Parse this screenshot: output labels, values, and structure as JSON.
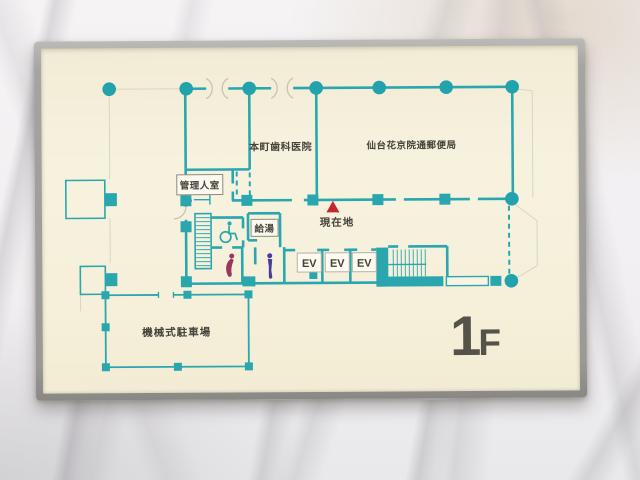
{
  "sign": {
    "floor": {
      "number": "1",
      "suffix": "F"
    },
    "current_location_label": "現在地",
    "rooms": {
      "dental_clinic": "本町歯科医院",
      "post_office": "仙台花京院通郵便局",
      "manager_room": "管理人室",
      "hot_water": "給湯",
      "parking": "機械式駐車場"
    },
    "elevators": [
      "EV",
      "EV",
      "EV"
    ],
    "icons": {
      "current_location_marker": "red-triangle",
      "wheelchair_accessible": "wheelchair-icon",
      "womens_restroom": "female-figure-icon",
      "mens_restroom": "male-figure-icon",
      "structural_columns": "teal-dot",
      "stairs": "hatched-stairs",
      "entrance_doors": "double-swing-door-arcs"
    },
    "colors": {
      "wall_teal": "#2AA6AE",
      "board_cream": "#F6F0DB",
      "frame_gray": "#A5A3A0",
      "marker_red": "#C1272D",
      "female_icon": "#97395F",
      "male_icon": "#4A3A99",
      "label_text": "#45423A"
    }
  }
}
